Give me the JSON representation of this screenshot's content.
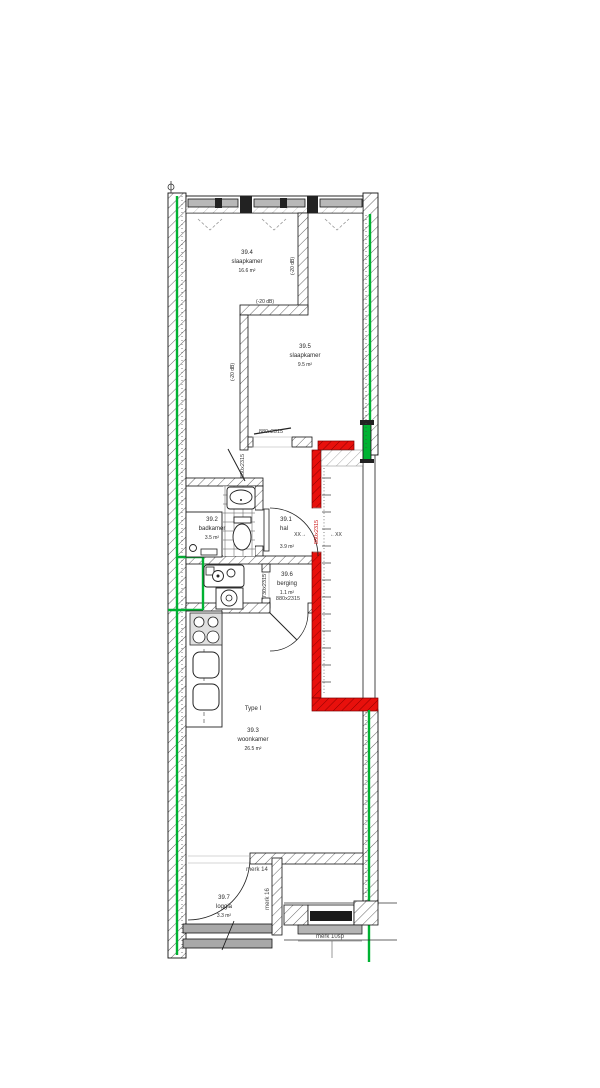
{
  "drawing_title": "apartment floor plan Type I nr 39",
  "rooms": {
    "r394": {
      "id": "39.4",
      "name": "slaapkamer",
      "area": "16.6 m²"
    },
    "r395": {
      "id": "39.5",
      "name": "slaapkamer",
      "area": "9.5 m²"
    },
    "r392": {
      "id": "39.2",
      "name": "badkamer",
      "area": "3.5 m²"
    },
    "r391": {
      "id": "39.1",
      "name": "hal",
      "area": "3.9 m²"
    },
    "r396": {
      "id": "39.6",
      "name": "berging",
      "area": "1.1 m²"
    },
    "r393": {
      "id": "39.3",
      "name": "woonkamer",
      "area": "26.5 m²",
      "type_label": "Type I"
    },
    "r397": {
      "id": "39.7",
      "name": "loggia",
      "area": "3.3 m²"
    }
  },
  "annotations": {
    "acoustic": "(-20 dB)",
    "door_880": "880x2315",
    "door_730": "730x2315",
    "entrance_door": "880x2315",
    "clearance_left": "XX→",
    "clearance_right": "←XX",
    "merk_14": "merk 14",
    "merk_16": "merk 16",
    "merk_10sp": "merk 10sp"
  },
  "colors": {
    "new_element_green": "#00b232",
    "fire_wall_red": "#e8100c",
    "wall_hatch": "#606060",
    "window_frame_gray": "#b8b8b8",
    "dark_frame": "#1a1a1a"
  }
}
